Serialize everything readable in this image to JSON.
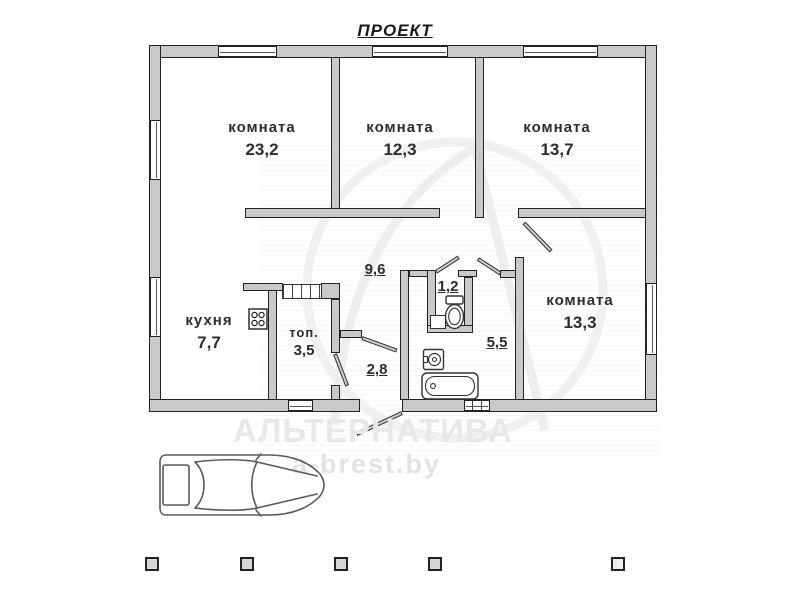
{
  "title": "ПРОЕКТ",
  "plan": {
    "rooms": [
      {
        "name": "комната",
        "area": "23,2"
      },
      {
        "name": "комната",
        "area": "12,3"
      },
      {
        "name": "комната",
        "area": "13,7"
      },
      {
        "name": "кухня",
        "area": "7,7"
      },
      {
        "name": "топ.",
        "area": "3,5"
      },
      {
        "name": "комната",
        "area": "13,3"
      }
    ],
    "spaces": {
      "hallway": "9,6",
      "wc": "1,2",
      "entry": "2,8",
      "bathroom": "5,5"
    }
  },
  "watermark": {
    "brand": "АЛЬТЕРНАТИВА",
    "site": "a-brest.by"
  },
  "colors": {
    "wall_fill": "#c9c9c9",
    "outline": "#222222",
    "label": "#2d2d2d",
    "watermark": "#e8e8e8"
  }
}
